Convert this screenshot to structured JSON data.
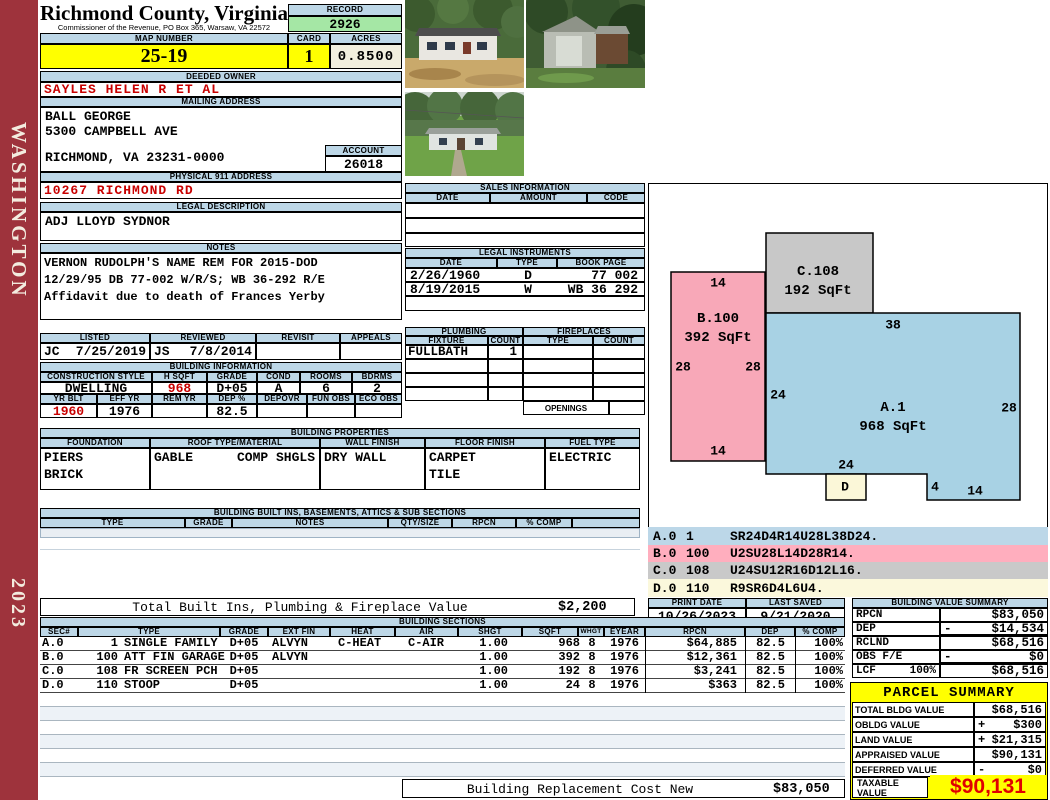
{
  "sidebar": {
    "district": "WASHINGTON",
    "year": "2023"
  },
  "header": {
    "title": "Richmond County, Virginia",
    "subtitle": "Commissioner of the Revenue, PO Box 365, Warsaw, VA 22572",
    "record_label": "RECORD",
    "record_value": "2926",
    "map_number_label": "MAP NUMBER",
    "map_number": "25-19",
    "card_label": "CARD",
    "card": "1",
    "acres_label": "ACRES",
    "acres": "0.8500"
  },
  "owner": {
    "deeded_owner_label": "DEEDED OWNER",
    "deeded_owner": "SAYLES HELEN R ET AL",
    "mailing_address_label": "MAILING ADDRESS",
    "mailing_line1": "BALL GEORGE",
    "mailing_line2": "5300 CAMPBELL AVE",
    "mailing_line3": "RICHMOND, VA 23231-0000",
    "account_label": "ACCOUNT",
    "account": "26018",
    "physical_address_label": "PHYSICAL 911 ADDRESS",
    "physical_address": "10267 RICHMOND RD",
    "legal_description_label": "LEGAL DESCRIPTION",
    "legal_description": "ADJ LLOYD SYDNOR",
    "notes_label": "NOTES",
    "notes_line1": "VERNON RUDOLPH'S NAME REM FOR 2015-DOD",
    "notes_line2": "12/29/95 DB 77-002 W/R/S; WB 36-292 R/E",
    "notes_line3": "Affidavit due to death of Frances Yerby"
  },
  "review": {
    "listed_label": "LISTED",
    "listed_by": "JC",
    "listed_date": "7/25/2019",
    "reviewed_label": "REVIEWED",
    "reviewed_by": "JS",
    "reviewed_date": "7/8/2014",
    "revisit_label": "REVISIT",
    "appeals_label": "APPEALS"
  },
  "building_information": {
    "section_label": "BUILDING INFORMATION",
    "construction_style_label": "CONSTRUCTION STYLE",
    "construction_style": "DWELLING",
    "hsqft_label": "H SQFT",
    "hsqft": "968",
    "grade_label": "GRADE",
    "grade": "D+05",
    "cond_label": "COND",
    "cond": "A",
    "rooms_label": "ROOMS",
    "rooms": "6",
    "bdrms_label": "BDRMS",
    "bdrms": "2",
    "yr_blt_label": "YR BLT",
    "yr_blt": "1960",
    "eff_yr_label": "EFF YR",
    "eff_yr": "1976",
    "rem_yr_label": "REM YR",
    "rem_yr": "",
    "dep_label": "DEP %",
    "dep": "82.5",
    "depovr_label": "DEPOVR",
    "depovr": "",
    "fun_obs_label": "FUN OBS",
    "fun_obs": "",
    "eco_obs_label": "ECO OBS",
    "eco_obs": ""
  },
  "building_properties": {
    "section_label": "BUILDING PROPERTIES",
    "foundation_label": "FOUNDATION",
    "foundation_line1": "PIERS",
    "foundation_line2": "BRICK",
    "roof_label": "ROOF TYPE/MATERIAL",
    "roof_type": "GABLE",
    "roof_material": "COMP SHGLS",
    "wall_finish_label": "WALL FINISH",
    "wall_finish": "DRY WALL",
    "floor_finish_label": "FLOOR FINISH",
    "floor_finish_line1": "CARPET",
    "floor_finish_line2": "TILE",
    "fuel_type_label": "FUEL TYPE",
    "fuel_type": "ELECTRIC"
  },
  "built_ins": {
    "section_label": "BUILDING BUILT INS, BASEMENTS, ATTICS & SUB SECTIONS",
    "columns": [
      "TYPE",
      "GRADE",
      "NOTES",
      "QTY/SIZE",
      "RPCN",
      "% COMP"
    ]
  },
  "sales_information": {
    "section_label": "SALES INFORMATION",
    "columns": [
      "DATE",
      "AMOUNT",
      "CODE"
    ]
  },
  "legal_instruments": {
    "section_label": "LEGAL INSTRUMENTS",
    "columns": [
      "DATE",
      "TYPE",
      "BOOK PAGE"
    ],
    "rows": [
      {
        "date": "2/26/1960",
        "type": "D",
        "book_page": "77 002"
      },
      {
        "date": "8/19/2015",
        "type": "W",
        "book_page": "WB 36 292"
      }
    ]
  },
  "plumbing": {
    "section_label": "PLUMBING",
    "fixture_label": "FIXTURE",
    "count_label": "COUNT",
    "fixture1": "FULLBATH",
    "count1": "1"
  },
  "fireplaces": {
    "section_label": "FIREPLACES",
    "type_label": "TYPE",
    "count_label": "COUNT",
    "openings_label": "OPENINGS"
  },
  "sketch": {
    "a_name": "A.1",
    "a_sqft": "968 SqFt",
    "b_name": "B.100",
    "b_sqft": "392 SqFt",
    "c_name": "C.108",
    "c_sqft": "192 SqFt",
    "d_name": "D",
    "dims": {
      "b_top": "14",
      "b_left": "28",
      "b_right": "28",
      "b_bottom": "14",
      "a_top": "38",
      "a_left": "24",
      "a_right": "28",
      "a_bottom": "24",
      "a_step": "4",
      "a_bottom_right": "14"
    }
  },
  "section_codes": {
    "rows": [
      {
        "sec": "A.0",
        "code": "1",
        "path": "SR24D4R14U28L38D24."
      },
      {
        "sec": "B.0",
        "code": "100",
        "path": "U2SU28L14D28R14."
      },
      {
        "sec": "C.0",
        "code": "108",
        "path": "U24SU12R16D12L16."
      },
      {
        "sec": "D.0",
        "code": "110",
        "path": "R9SR6D4L6U4."
      }
    ]
  },
  "print_info": {
    "print_date_label": "PRINT DATE",
    "print_date": "10/26/2023",
    "last_saved_label": "LAST SAVED",
    "last_saved": "9/21/2020"
  },
  "building_value_summary": {
    "section_label": "BUILDING VALUE SUMMARY",
    "rows": [
      {
        "label": "RPCN",
        "pct": "",
        "sign": "",
        "value": "$83,050"
      },
      {
        "label": "DEP",
        "pct": "",
        "sign": "-",
        "value": "$14,534"
      },
      {
        "label": "RCLND",
        "pct": "",
        "sign": "",
        "value": "$68,516"
      },
      {
        "label": "OBS F/E",
        "pct": "",
        "sign": "-",
        "value": "$0"
      },
      {
        "label": "LCF",
        "pct": "100%",
        "sign": "",
        "value": "$68,516"
      }
    ]
  },
  "totals": {
    "built_ins_total_label": "Total Built Ins, Plumbing & Fireplace Value",
    "built_ins_total": "$2,200",
    "replacement_label": "Building Replacement Cost New",
    "replacement_value": "$83,050"
  },
  "building_sections": {
    "section_label": "BUILDING SECTIONS",
    "columns": [
      "SEC#",
      "TYPE",
      "GRADE",
      "EXT FIN",
      "HEAT",
      "AIR",
      "SHGT",
      "SQFT",
      "WHGT",
      "EYEAR",
      "RPCN",
      "DEP",
      "% COMP"
    ],
    "rows": [
      {
        "sec": "A.0",
        "code": "1",
        "type": "SINGLE FAMILY",
        "grade": "D+05",
        "ext_fin": "ALVYN",
        "heat": "C-HEAT",
        "air": "C-AIR",
        "shgt": "1.00",
        "sqft": "968",
        "whgt": "8",
        "eyear": "1976",
        "rpcn": "$64,885",
        "dep": "82.5",
        "comp": "100%"
      },
      {
        "sec": "B.0",
        "code": "100",
        "type": "ATT FIN GARAGE",
        "grade": "D+05",
        "ext_fin": "ALVYN",
        "heat": "",
        "air": "",
        "shgt": "1.00",
        "sqft": "392",
        "whgt": "8",
        "eyear": "1976",
        "rpcn": "$12,361",
        "dep": "82.5",
        "comp": "100%"
      },
      {
        "sec": "C.0",
        "code": "108",
        "type": "FR SCREEN PCH",
        "grade": "D+05",
        "ext_fin": "",
        "heat": "",
        "air": "",
        "shgt": "1.00",
        "sqft": "192",
        "whgt": "8",
        "eyear": "1976",
        "rpcn": "$3,241",
        "dep": "82.5",
        "comp": "100%"
      },
      {
        "sec": "D.0",
        "code": "110",
        "type": "STOOP",
        "grade": "D+05",
        "ext_fin": "",
        "heat": "",
        "air": "",
        "shgt": "1.00",
        "sqft": "24",
        "whgt": "8",
        "eyear": "1976",
        "rpcn": "$363",
        "dep": "82.5",
        "comp": "100%"
      }
    ]
  },
  "parcel_summary": {
    "section_label": "PARCEL SUMMARY",
    "rows": [
      {
        "label": "TOTAL BLDG VALUE",
        "sign": "",
        "value": "$68,516"
      },
      {
        "label": "OBLDG VALUE",
        "sign": "+",
        "value": "$300"
      },
      {
        "label": "LAND VALUE",
        "sign": "+",
        "value": "$21,315"
      },
      {
        "label": "APPRAISED VALUE",
        "sign": "",
        "value": "$90,131"
      },
      {
        "label": "DEFERRED VALUE",
        "sign": "-",
        "value": "$0"
      }
    ],
    "taxable_label_line1": "TAXABLE",
    "taxable_label_line2": "VALUE",
    "taxable_value": "$90,131"
  },
  "colors": {
    "sidebar_red": "#9E333C",
    "header_blue": "#BDD7E7",
    "highlight_yellow": "#FFFF00",
    "record_green": "#A5E7A5",
    "acres_cream": "#F2EFDE",
    "alert_red": "#C80000",
    "sketch_pink": "#F8A8B8",
    "sketch_blue": "#A8D2E4",
    "sketch_gray": "#C8C8C8",
    "sketch_cream": "#FBF7D8"
  }
}
